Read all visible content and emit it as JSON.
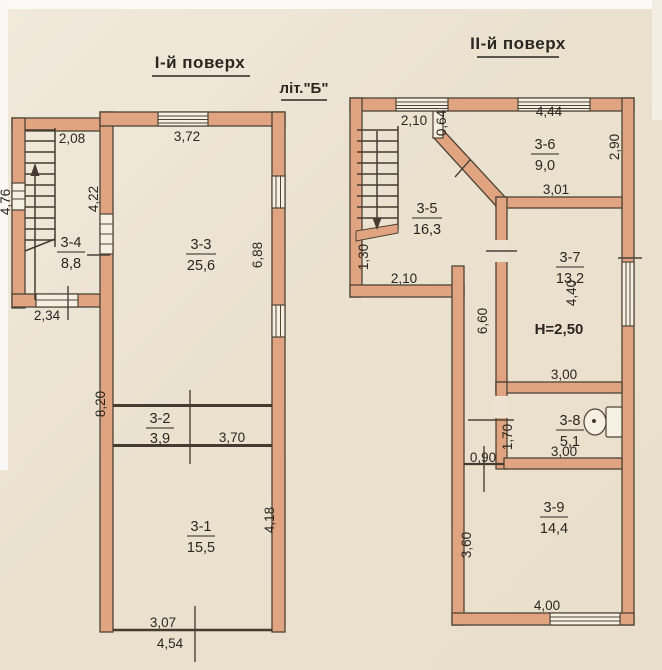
{
  "document": {
    "floor1": {
      "title": "І-й поверх",
      "building_letter": "літ.\"Б\"",
      "rooms": {
        "r31": {
          "code": "3-1",
          "area": "15,5"
        },
        "r32": {
          "code": "3-2",
          "area": "3,9"
        },
        "r33": {
          "code": "3-3",
          "area": "25,6"
        },
        "r34": {
          "code": "3-4",
          "area": "8,8"
        }
      },
      "dims": {
        "annex_top": "2,08",
        "main_top_window": "3,72",
        "annex_left": "4,76",
        "shared_wall": "4,22",
        "right_upper": "6,88",
        "annex_bottom": "2,34",
        "left_lower": "8,20",
        "room32_width": "3,70",
        "room31_right": "4,18",
        "bottom_inner": "3,07",
        "bottom_total": "4,54"
      }
    },
    "floor2": {
      "title": "ІІ-й поверх",
      "ceiling_height": "H=2,50",
      "rooms": {
        "r35": {
          "code": "3-5",
          "area": "16,3"
        },
        "r36": {
          "code": "3-6",
          "area": "9,0"
        },
        "r37": {
          "code": "3-7",
          "area": "13,2"
        },
        "r38": {
          "code": "3-8",
          "area": "5,1"
        },
        "r39": {
          "code": "3-9",
          "area": "14,4"
        }
      },
      "dims": {
        "top_left_window": "2,10",
        "entry_stub": "0,64",
        "top_right_window": "4,44",
        "right_upper": "2,90",
        "room36_bottom": "3,01",
        "left_segment": "1,30",
        "hall_bottom": "2,10",
        "corridor_wall": "6,60",
        "room37_right": "4,40",
        "room37_bottom": "3,00",
        "wc_wall": "1,70",
        "step": "0,90",
        "wc_bottom": "3,00",
        "room39_left": "3,60",
        "room39_bottom": "4,00"
      }
    },
    "colors": {
      "wall_fill": "#e0a480",
      "wall_outline": "#4e4336",
      "paper": "#ebe2d1",
      "ink": "#2b2620"
    }
  }
}
